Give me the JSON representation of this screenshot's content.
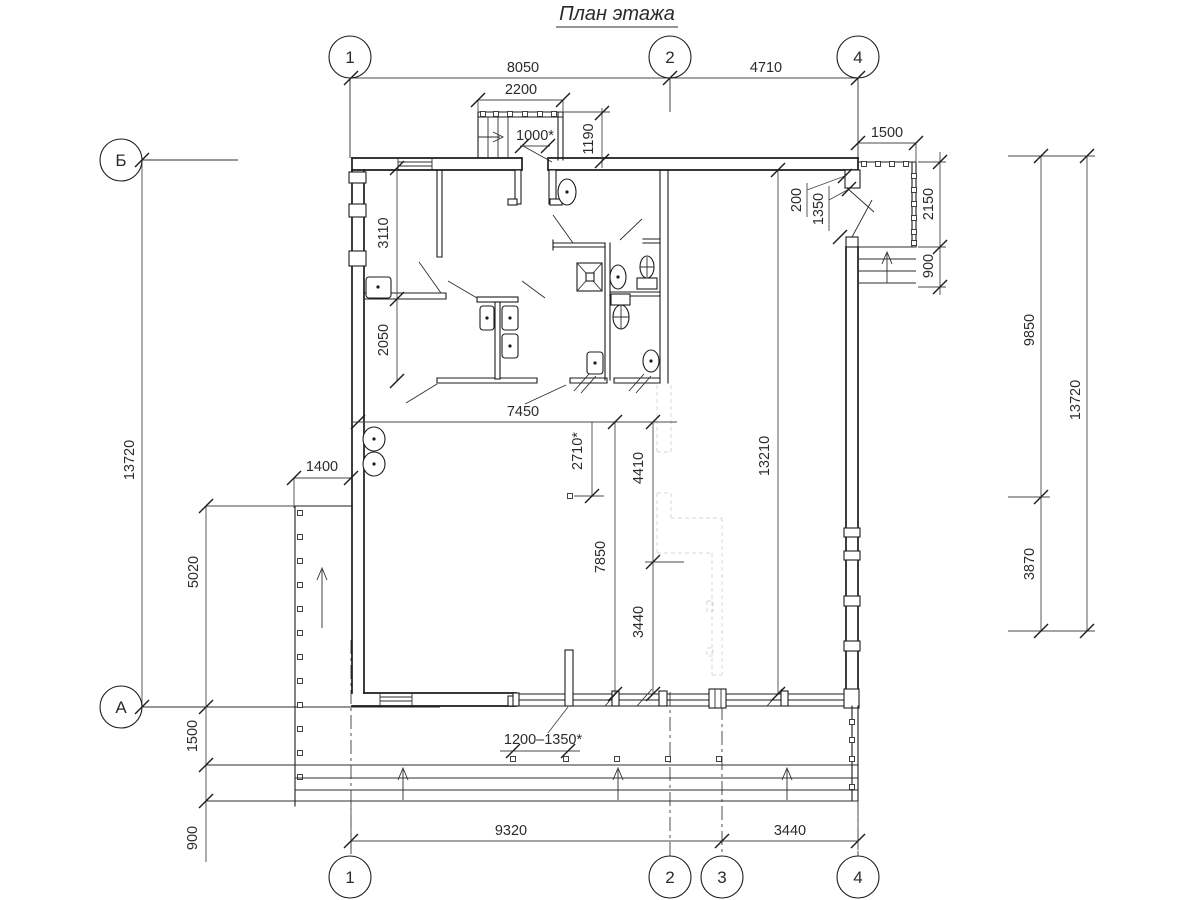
{
  "title": "План этажа",
  "axes": {
    "top": [
      "1",
      "2",
      "4"
    ],
    "bottom": [
      "1",
      "2",
      "3",
      "4"
    ],
    "left": [
      "Б",
      "А"
    ]
  },
  "dims": {
    "top_8050": "8050",
    "top_4710": "4710",
    "stair_2200": "2200",
    "stair_1000": "1000*",
    "entry_1190": "1190",
    "porch_1500": "1500",
    "door_200": "200",
    "door_1350": "1350",
    "porch_2150": "2150",
    "porch_900": "900",
    "right_9850": "9850",
    "right_13720": "13720",
    "right_3870": "3870",
    "left_13720": "13720",
    "room_3110": "3110",
    "room_2050": "2050",
    "ramp_1400": "1400",
    "ramp_5020": "5020",
    "terrace_1500": "1500",
    "terrace_900": "900",
    "hall_7450": "7450",
    "hall_2710": "2710*",
    "hall_7850": "7850",
    "hall_4410": "4410",
    "hall_3440": "3440",
    "hall_13210": "13210",
    "window_range": "1200–1350*",
    "bottom_9320": "9320",
    "bottom_3440": "3440"
  }
}
